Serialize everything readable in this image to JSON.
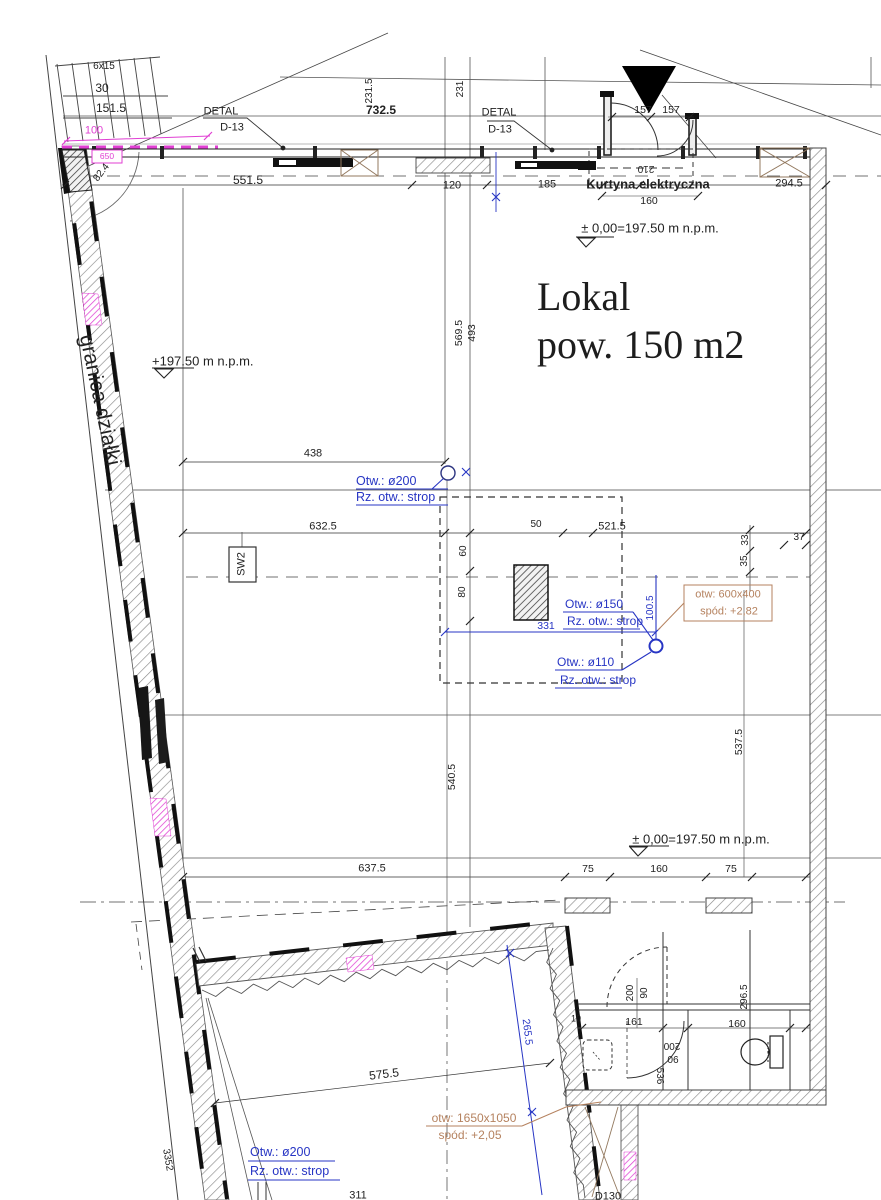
{
  "drawing": {
    "room": {
      "line1": "Lokal",
      "line2": "pow. 150 m2"
    },
    "colors": {
      "k": "#222222",
      "b": "#2735c4",
      "o": "#b5825f",
      "p": "#e03fd3"
    },
    "labels": [
      {
        "name": "plot-boundary-label",
        "text": "granica działki",
        "x": 100,
        "y": 400,
        "rot": 78,
        "size": 21
      },
      {
        "name": "stair-steps",
        "text": "6x15",
        "x": 104,
        "y": 67,
        "size": 10
      },
      {
        "name": "stair-tread",
        "text": "30",
        "x": 102,
        "y": 88,
        "size": 12
      },
      {
        "name": "stair-length",
        "text": "151.5",
        "x": 111,
        "y": 108,
        "size": 12
      },
      {
        "name": "dim-100-pink",
        "text": "100",
        "x": 94,
        "y": 131,
        "size": 11,
        "color": "p"
      },
      {
        "name": "wall-tag-650",
        "text": "650",
        "x": 107,
        "y": 156,
        "size": 8.5,
        "color": "p"
      },
      {
        "name": "angle-82-4",
        "text": "82.4",
        "x": 102,
        "y": 173,
        "rot": -52,
        "size": 10
      },
      {
        "name": "detail-callout-1a",
        "text": "DETAL",
        "x": 221,
        "y": 112,
        "size": 11
      },
      {
        "name": "detail-callout-1b",
        "text": "D-13",
        "x": 232,
        "y": 128,
        "size": 11
      },
      {
        "name": "dim-551-5",
        "text": "551.5",
        "x": 248,
        "y": 180,
        "size": 12
      },
      {
        "name": "dim-732-5",
        "text": "732.5",
        "x": 381,
        "y": 110,
        "size": 12,
        "bold": true
      },
      {
        "name": "dim-231-5",
        "text": "231.5",
        "x": 370,
        "y": 91,
        "rot": -90,
        "size": 10
      },
      {
        "name": "dim-231",
        "text": "231",
        "x": 461,
        "y": 89,
        "rot": -90,
        "size": 10
      },
      {
        "name": "detail-callout-2a",
        "text": "DETAL",
        "x": 499,
        "y": 113,
        "size": 11
      },
      {
        "name": "detail-callout-2b",
        "text": "D-13",
        "x": 500,
        "y": 130,
        "size": 11
      },
      {
        "name": "dim-157-a",
        "text": "157",
        "x": 643,
        "y": 110,
        "size": 10.5
      },
      {
        "name": "dim-157-b",
        "text": "157",
        "x": 671,
        "y": 110,
        "size": 10.5
      },
      {
        "name": "dim-120",
        "text": "120",
        "x": 452,
        "y": 186,
        "size": 11
      },
      {
        "name": "dim-185",
        "text": "185",
        "x": 547,
        "y": 185,
        "size": 11
      },
      {
        "name": "curtain-label",
        "text": "Kurtyna elektryczna",
        "x": 648,
        "y": 184,
        "size": 13,
        "bold": true
      },
      {
        "name": "dim-294-5",
        "text": "294.5",
        "x": 789,
        "y": 184,
        "size": 11
      },
      {
        "name": "dim-210-flipped",
        "text": "210",
        "x": 646,
        "y": 168,
        "rot": 180,
        "size": 10
      },
      {
        "name": "dim-160-top",
        "text": "160",
        "x": 649,
        "y": 201,
        "size": 10.5
      },
      {
        "name": "level-note-1",
        "text": "± 0,00=197.50 m n.p.m.",
        "x": 650,
        "y": 228,
        "size": 13
      },
      {
        "name": "level-note-2",
        "text": "+197.50 m n.p.m.",
        "x": 152,
        "y": 361,
        "size": 13,
        "align": "l"
      },
      {
        "name": "dim-438",
        "text": "438",
        "x": 313,
        "y": 454,
        "size": 11
      },
      {
        "name": "note-otw-200-top-1",
        "text": "Otw.: ø200",
        "x": 356,
        "y": 481,
        "size": 12.5,
        "color": "b",
        "align": "l"
      },
      {
        "name": "note-otw-200-top-2",
        "text": "Rz. otw.: strop",
        "x": 356,
        "y": 497,
        "size": 12.5,
        "color": "b",
        "align": "l"
      },
      {
        "name": "dim-632-5",
        "text": "632.5",
        "x": 323,
        "y": 527,
        "size": 11
      },
      {
        "name": "tag-sw2",
        "text": "SW2",
        "x": 242,
        "y": 564,
        "rot": -90,
        "size": 11
      },
      {
        "name": "dim-60",
        "text": "60",
        "x": 464,
        "y": 551,
        "rot": -90,
        "size": 10
      },
      {
        "name": "dim-80",
        "text": "80",
        "x": 463,
        "y": 592,
        "rot": -90,
        "size": 10
      },
      {
        "name": "dim-50",
        "text": "50",
        "x": 536,
        "y": 525,
        "size": 10
      },
      {
        "name": "dim-521-5",
        "text": "521.5",
        "x": 612,
        "y": 527,
        "size": 11
      },
      {
        "name": "dim-33",
        "text": "33",
        "x": 746,
        "y": 540,
        "rot": -90,
        "size": 10
      },
      {
        "name": "dim-35",
        "text": "35",
        "x": 745,
        "y": 561,
        "rot": -90,
        "size": 10
      },
      {
        "name": "dim-37",
        "text": "37",
        "x": 799,
        "y": 538,
        "size": 10
      },
      {
        "name": "note-otw-600x400",
        "text": "otw: 600x400",
        "x": 728,
        "y": 595,
        "size": 11,
        "color": "o"
      },
      {
        "name": "note-spod-282",
        "text": "spód: +2,82",
        "x": 729,
        "y": 612,
        "size": 11,
        "color": "o"
      },
      {
        "name": "note-otw-150-1",
        "text": "Otw.: ø150",
        "x": 565,
        "y": 604,
        "size": 12,
        "color": "b",
        "align": "l"
      },
      {
        "name": "note-otw-150-2",
        "text": "Rz. otw.: strop",
        "x": 567,
        "y": 621,
        "size": 12,
        "color": "b",
        "align": "l"
      },
      {
        "name": "dim-100-5",
        "text": "100.5",
        "x": 651,
        "y": 608,
        "rot": -90,
        "size": 10,
        "color": "b"
      },
      {
        "name": "dim-331",
        "text": "331",
        "x": 546,
        "y": 626,
        "size": 10.5,
        "color": "b"
      },
      {
        "name": "note-otw-110-1",
        "text": "Otw.: ø110",
        "x": 557,
        "y": 662,
        "size": 12,
        "color": "b",
        "align": "l"
      },
      {
        "name": "note-otw-110-2",
        "text": "Rz. otw.: strop",
        "x": 560,
        "y": 680,
        "size": 12,
        "color": "b",
        "align": "l"
      },
      {
        "name": "dim-569-5",
        "text": "569.5",
        "x": 459,
        "y": 333,
        "rot": -90,
        "size": 10.5
      },
      {
        "name": "dim-493",
        "text": "493",
        "x": 472,
        "y": 333,
        "rot": -90,
        "size": 10.5
      },
      {
        "name": "dim-540-5",
        "text": "540.5",
        "x": 452,
        "y": 777,
        "rot": -90,
        "size": 10.5
      },
      {
        "name": "dim-537-5",
        "text": "537.5",
        "x": 739,
        "y": 742,
        "rot": -90,
        "size": 10.5
      },
      {
        "name": "level-note-3",
        "text": "± 0,00=197.50 m n.p.m.",
        "x": 701,
        "y": 839,
        "size": 13
      },
      {
        "name": "dim-637-5",
        "text": "637.5",
        "x": 372,
        "y": 869,
        "size": 11
      },
      {
        "name": "dim-75-a",
        "text": "75",
        "x": 588,
        "y": 869,
        "size": 10.5
      },
      {
        "name": "dim-160-mid",
        "text": "160",
        "x": 659,
        "y": 869,
        "size": 10.5
      },
      {
        "name": "dim-75-b",
        "text": "75",
        "x": 731,
        "y": 869,
        "size": 10.5
      },
      {
        "name": "dim-10",
        "text": "10",
        "x": 576,
        "y": 1019,
        "size": 9
      },
      {
        "name": "dim-161",
        "text": "161",
        "x": 634,
        "y": 1022,
        "size": 10.5
      },
      {
        "name": "dim-160-bath",
        "text": "160",
        "x": 737,
        "y": 1024,
        "size": 10.5
      },
      {
        "name": "dim-296-5",
        "text": "296.5",
        "x": 745,
        "y": 997,
        "rot": -90,
        "size": 10
      },
      {
        "name": "dim-200-door",
        "text": "200",
        "x": 631,
        "y": 993,
        "rot": -90,
        "size": 10
      },
      {
        "name": "dim-90-door",
        "text": "90",
        "x": 645,
        "y": 993,
        "rot": -90,
        "size": 10
      },
      {
        "name": "dim-200-flipped",
        "text": "200",
        "x": 672,
        "y": 1045,
        "rot": 180,
        "size": 10
      },
      {
        "name": "dim-90-flipped",
        "text": "90",
        "x": 673,
        "y": 1058,
        "rot": 180,
        "size": 10
      },
      {
        "name": "dim-536",
        "text": "536",
        "x": 659,
        "y": 1076,
        "rot": 90,
        "size": 10
      },
      {
        "name": "dim-265-5",
        "text": "265.5",
        "x": 527,
        "y": 1032,
        "rot": 83,
        "size": 10.5,
        "color": "b"
      },
      {
        "name": "dim-575-5",
        "text": "575.5",
        "x": 384,
        "y": 1074,
        "rot": -7,
        "size": 12
      },
      {
        "name": "note-otw-1650x1050",
        "text": "otw: 1650x1050",
        "x": 474,
        "y": 1118,
        "size": 12,
        "color": "o"
      },
      {
        "name": "note-spod-205",
        "text": "spód: +2,05",
        "x": 470,
        "y": 1135,
        "size": 12,
        "color": "o"
      },
      {
        "name": "note-otw-200-bot-1",
        "text": "Otw.: ø200",
        "x": 250,
        "y": 1152,
        "size": 12.5,
        "color": "b",
        "align": "l"
      },
      {
        "name": "note-otw-200-bot-2",
        "text": "Rz. otw.: strop",
        "x": 250,
        "y": 1171,
        "size": 12.5,
        "color": "b",
        "align": "l"
      },
      {
        "name": "dim-311",
        "text": "311",
        "x": 358,
        "y": 1196,
        "size": 11
      },
      {
        "name": "tag-d130",
        "text": "D130",
        "x": 608,
        "y": 1197,
        "size": 11
      },
      {
        "name": "dim-3352",
        "text": "3352",
        "x": 167,
        "y": 1160,
        "rot": 80,
        "size": 10
      }
    ]
  }
}
